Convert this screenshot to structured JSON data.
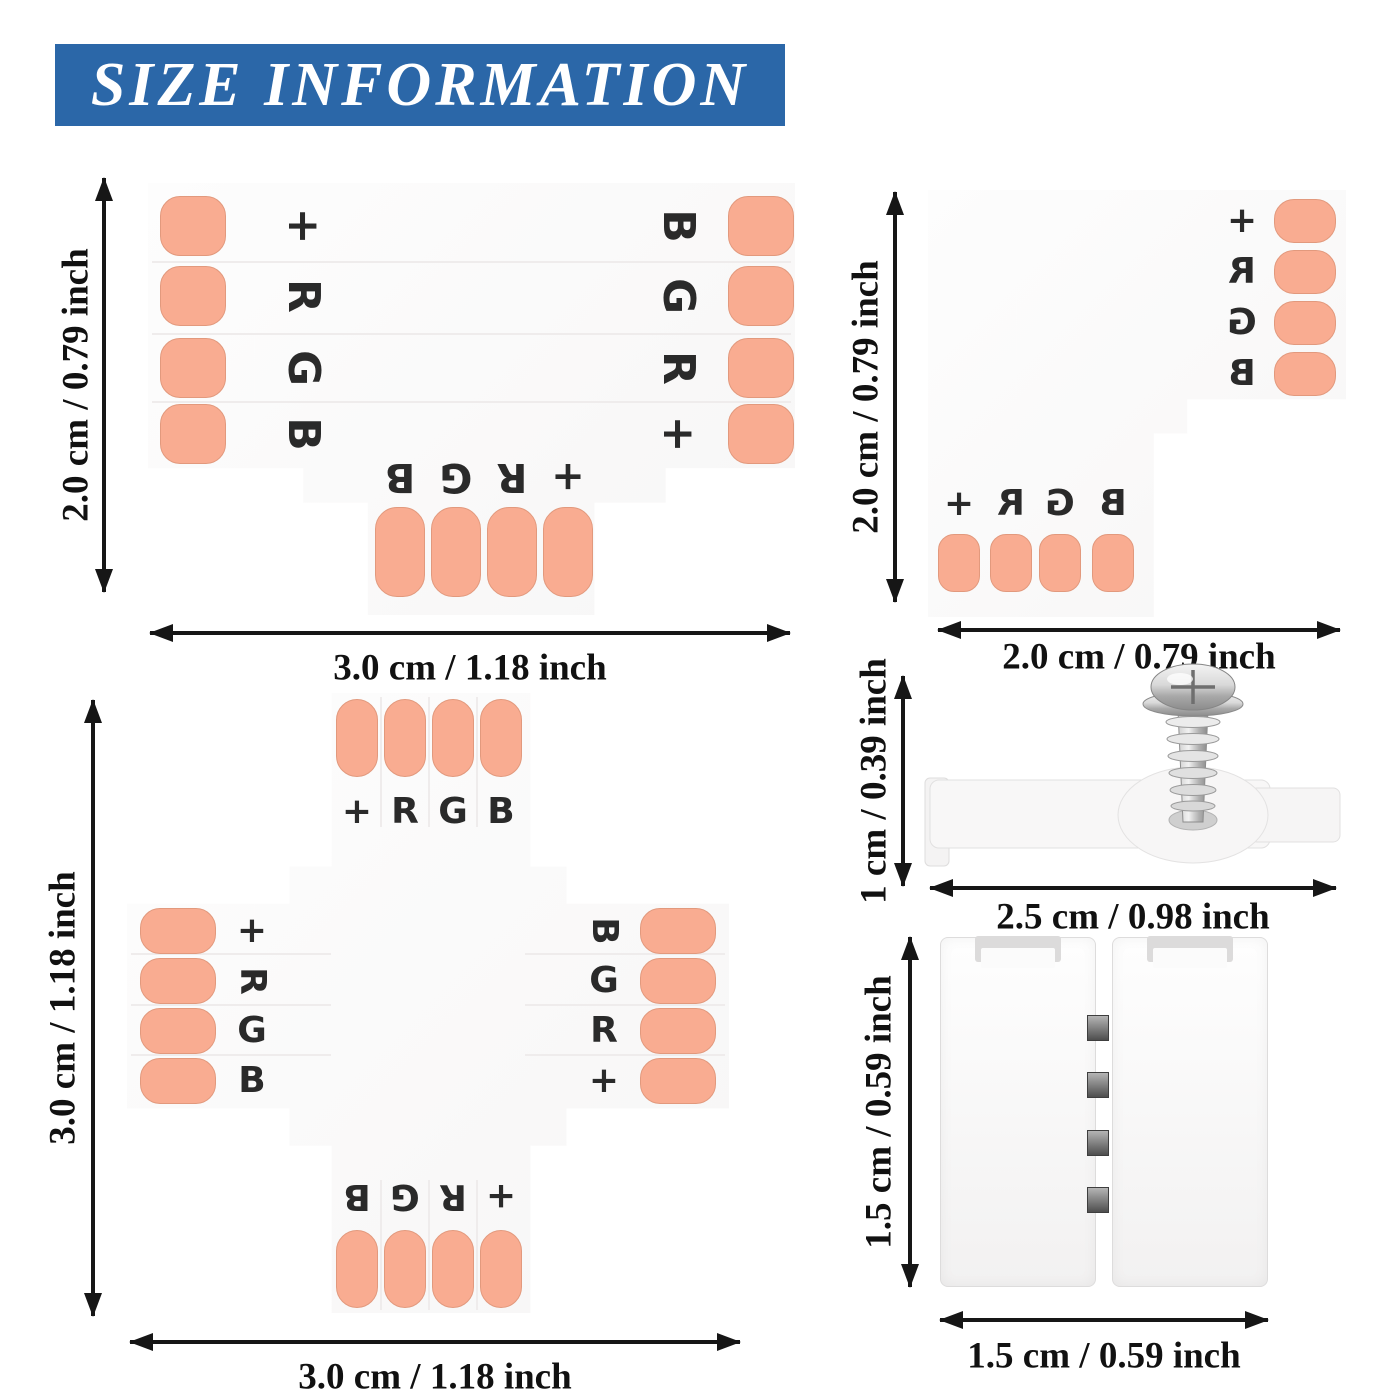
{
  "banner": {
    "title": "SIZE INFORMATION",
    "bg_color": "#2b67a8",
    "text_color": "#ffffff"
  },
  "colors": {
    "copper_pad": "#f9ac91",
    "arrow": "#161616",
    "board": "#fbfafa"
  },
  "t_connector": {
    "name": "T-shape 4-pin connector",
    "left_pins": [
      "+",
      "R",
      "G",
      "B"
    ],
    "right_pins": [
      "B",
      "G",
      "R",
      "+"
    ],
    "bottom_pins": [
      "B",
      "G",
      "R",
      "+"
    ],
    "height_label": "2.0 cm / 0.79 inch",
    "width_label": "3.0 cm / 1.18 inch"
  },
  "l_connector": {
    "name": "L-shape 4-pin connector",
    "right_pins": [
      "+",
      "R",
      "G",
      "B"
    ],
    "bottom_pins": [
      "+",
      "R",
      "G",
      "B"
    ],
    "height_label": "2.0 cm / 0.79 inch",
    "width_label": "2.0 cm / 0.79 inch"
  },
  "mounting_clip": {
    "name": "Strip mounting clip with screw",
    "height_label": "1 cm / 0.39 inch",
    "width_label": "2.5 cm / 0.98 inch"
  },
  "cross_connector": {
    "name": "Cross-shape 4-pin connector",
    "top_pins": [
      "+",
      "R",
      "G",
      "B"
    ],
    "left_pins": [
      "+",
      "R",
      "G",
      "B"
    ],
    "right_pins": [
      "B",
      "G",
      "R",
      "+"
    ],
    "bottom_pins": [
      "B",
      "G",
      "R",
      "+"
    ],
    "height_label": "3.0 cm / 1.18 inch",
    "width_label": "3.0 cm / 1.18 inch"
  },
  "gapless_connector": {
    "name": "Gapless strip-to-strip connector",
    "height_label": "1.5 cm / 0.59 inch",
    "width_label": "1.5 cm / 0.59 inch"
  }
}
